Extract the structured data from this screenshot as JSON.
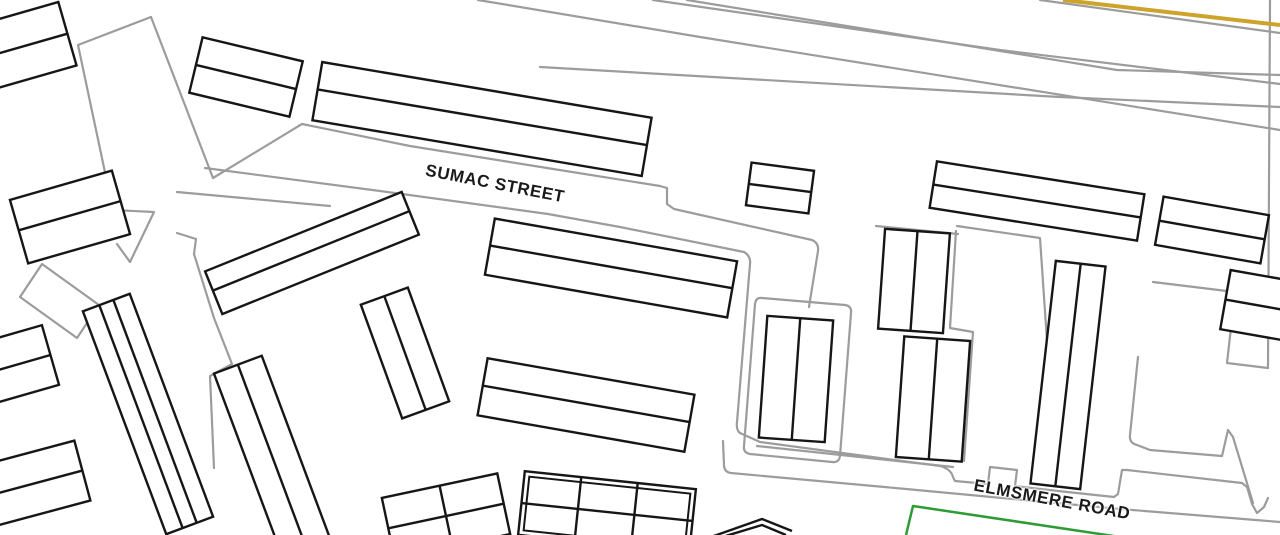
{
  "map_data": {
    "type": "vector-street-map",
    "streets": [
      {
        "id": "sumac-street",
        "name": "SUMAC STREET",
        "x": 495,
        "y": 184,
        "rotation": 11
      },
      {
        "id": "elmsmere-road",
        "name": "ELMSMERE ROAD",
        "x": 1052,
        "y": 500,
        "rotation": 10.5
      }
    ],
    "colors": {
      "background": "#ffffff",
      "building_stroke": "#161616",
      "parcel_stroke": "#9c9c9c",
      "accent_road": "#cda32b",
      "green_boundary": "#2e9b35",
      "label": "#1a1a1a"
    },
    "accent_path": "M1063,0 L1280,25",
    "green_path": "M906,535 L913,506 L1120,537",
    "parcel_paths": [
      "M478,0 L700,37 L1280,130",
      "M653,0 L1000,50 L1280,84",
      "M687,0 L1117,70 L1280,75",
      "M1040,0 L1280,33",
      "M540,67 L1060,97 L1280,107",
      "M1270,0 L1268,368",
      "M1153,282 L1235,292 L1227,363 L1268,368",
      "M151,17 L78,45 L113,210 L154,212 L130,262 L117,244",
      "M151,17 L213,178",
      "M213,178 L302,124 L410,146 L547,168 L660,186 L667,188 L667,204 L674,209 L812,240 Q819,243 818,251 L809,307",
      "M205,168 L380,191 L548,214 L620,227 L744,252 Q751,256 750,264 L737,422 Q736,430 740,433 L760,442 L940,466 Q951,469 953,477 L955,481 L988,484 L990,467 L1017,470 L1015,486 L1058,491 L1114,497 L1118,494 L1122,470 L1127,470 L1242,483 L1247,487 L1252,504 L1257,513 L1264,507 L1268,498",
      "M723,441 L724,465 Q724,472 731,473 L906,489 L1120,509 L1280,522",
      "M177,192 L330,206",
      "M177,233 L196,239 L194,254 L214,318 L232,364 L210,376 L214,468",
      "M876,226 L958,234",
      "M956,231 L950,328 L973,332 L964,461",
      "M757,446 L953,467",
      "M957,226 L1040,238 L1056,473",
      "M762,298 L845,305 Q852,306 851,313 L840,456 Q839,463 832,462 L750,454 Q743,453 744,446 L755,304 Q756,297 762,298 Z",
      "M42,264 L99,305 L77,338 L20,297 Z",
      "M1138,357 L1130,435 Q1129,443 1137,445 L1150,450 L1222,456 L1228,430 L1233,437 L1253,503"
    ],
    "buildings": [
      {
        "id": "bldg-nw-corner",
        "cx": 28,
        "cy": 45,
        "w": 82,
        "h": 66,
        "angle": -16,
        "hlines": [
          0.5
        ]
      },
      {
        "id": "bldg-top-small",
        "cx": 246,
        "cy": 77,
        "w": 103,
        "h": 57,
        "angle": 13.5,
        "hlines": [
          0.5
        ]
      },
      {
        "id": "bldg-sumac-long",
        "cx": 482,
        "cy": 119,
        "w": 334,
        "h": 59,
        "angle": 9.6,
        "hlines": [
          0.47
        ]
      },
      {
        "id": "bldg-square-small",
        "cx": 780,
        "cy": 188,
        "w": 63,
        "h": 43,
        "angle": 7.5,
        "hlines": [
          0.5
        ]
      },
      {
        "id": "bldg-east-long",
        "cx": 1037,
        "cy": 201,
        "w": 210,
        "h": 47,
        "angle": 9,
        "hlines": [
          0.5
        ]
      },
      {
        "id": "bldg-far-east",
        "cx": 1212,
        "cy": 230,
        "w": 107,
        "h": 49,
        "angle": 10,
        "hlines": [
          0.5
        ]
      },
      {
        "id": "bldg-far-east-lower",
        "cx": 1256,
        "cy": 305,
        "w": 62,
        "h": 60,
        "angle": 10,
        "hlines": [
          0.5
        ]
      },
      {
        "id": "bldg-tall-east",
        "cx": 1068,
        "cy": 375,
        "w": 50,
        "h": 224,
        "angle": 6.5,
        "vlines": [
          0.5
        ]
      },
      {
        "id": "bldg-block-north",
        "cx": 914,
        "cy": 281,
        "w": 65,
        "h": 100,
        "angle": 4,
        "vlines": [
          0.5
        ]
      },
      {
        "id": "bldg-block-south",
        "cx": 933,
        "cy": 399,
        "w": 66,
        "h": 121,
        "angle": 4,
        "vlines": [
          0.5
        ]
      },
      {
        "id": "bldg-block-west",
        "cx": 796,
        "cy": 379,
        "w": 66,
        "h": 122,
        "angle": 4,
        "vlines": [
          0.5
        ]
      },
      {
        "id": "bldg-left-tall",
        "cx": 148,
        "cy": 414,
        "w": 50,
        "h": 238,
        "angle": -20.5,
        "vlines": [
          0.35,
          0.65
        ]
      },
      {
        "id": "bldg-left-tall-2",
        "cx": 272,
        "cy": 456,
        "w": 51,
        "h": 195,
        "angle": -20.5,
        "vlines": [
          0.5
        ]
      },
      {
        "id": "bldg-diagonal",
        "cx": 312,
        "cy": 253,
        "w": 212,
        "h": 46,
        "angle": -22,
        "hlines": [
          0.45
        ]
      },
      {
        "id": "bldg-center-pair",
        "cx": 405,
        "cy": 353,
        "w": 50,
        "h": 121,
        "angle": -20,
        "vlines": [
          0.5
        ]
      },
      {
        "id": "bldg-center-long-n",
        "cx": 611,
        "cy": 268,
        "w": 246,
        "h": 57,
        "angle": 10,
        "hlines": [
          0.48
        ]
      },
      {
        "id": "bldg-center-long-s",
        "cx": 586,
        "cy": 405,
        "w": 210,
        "h": 58,
        "angle": 10,
        "hlines": [
          0.48
        ]
      },
      {
        "id": "bldg-west-small",
        "cx": 70,
        "cy": 217,
        "w": 106,
        "h": 66,
        "angle": -16,
        "hlines": [
          0.48
        ]
      },
      {
        "id": "bldg-west-edge",
        "cx": 12,
        "cy": 366,
        "w": 80,
        "h": 62,
        "angle": -16,
        "hlines": [
          0.5
        ]
      },
      {
        "id": "bldg-southwest",
        "cx": 36,
        "cy": 483,
        "w": 96,
        "h": 62,
        "angle": -15,
        "hlines": [
          0.5
        ]
      },
      {
        "id": "bldg-bottom-grid",
        "cx": 446,
        "cy": 516,
        "w": 118,
        "h": 62,
        "angle": -12,
        "vlines": [
          0.5
        ],
        "hlines": [
          0.5
        ]
      },
      {
        "id": "bldg-bottom-terrace",
        "cx": 607,
        "cy": 512,
        "w": 172,
        "h": 64,
        "angle": 6,
        "vlines": [
          0.33,
          0.66
        ],
        "hlines": [
          0.5
        ],
        "double": true
      }
    ],
    "building_extra_paths": [
      "M711,537 L762,519 L792,531",
      "M719,538 L762,525 L786,535"
    ],
    "stroke_widths": {
      "building": 2.4,
      "parcel": 2.2,
      "accent": 4,
      "green": 2.5
    }
  }
}
